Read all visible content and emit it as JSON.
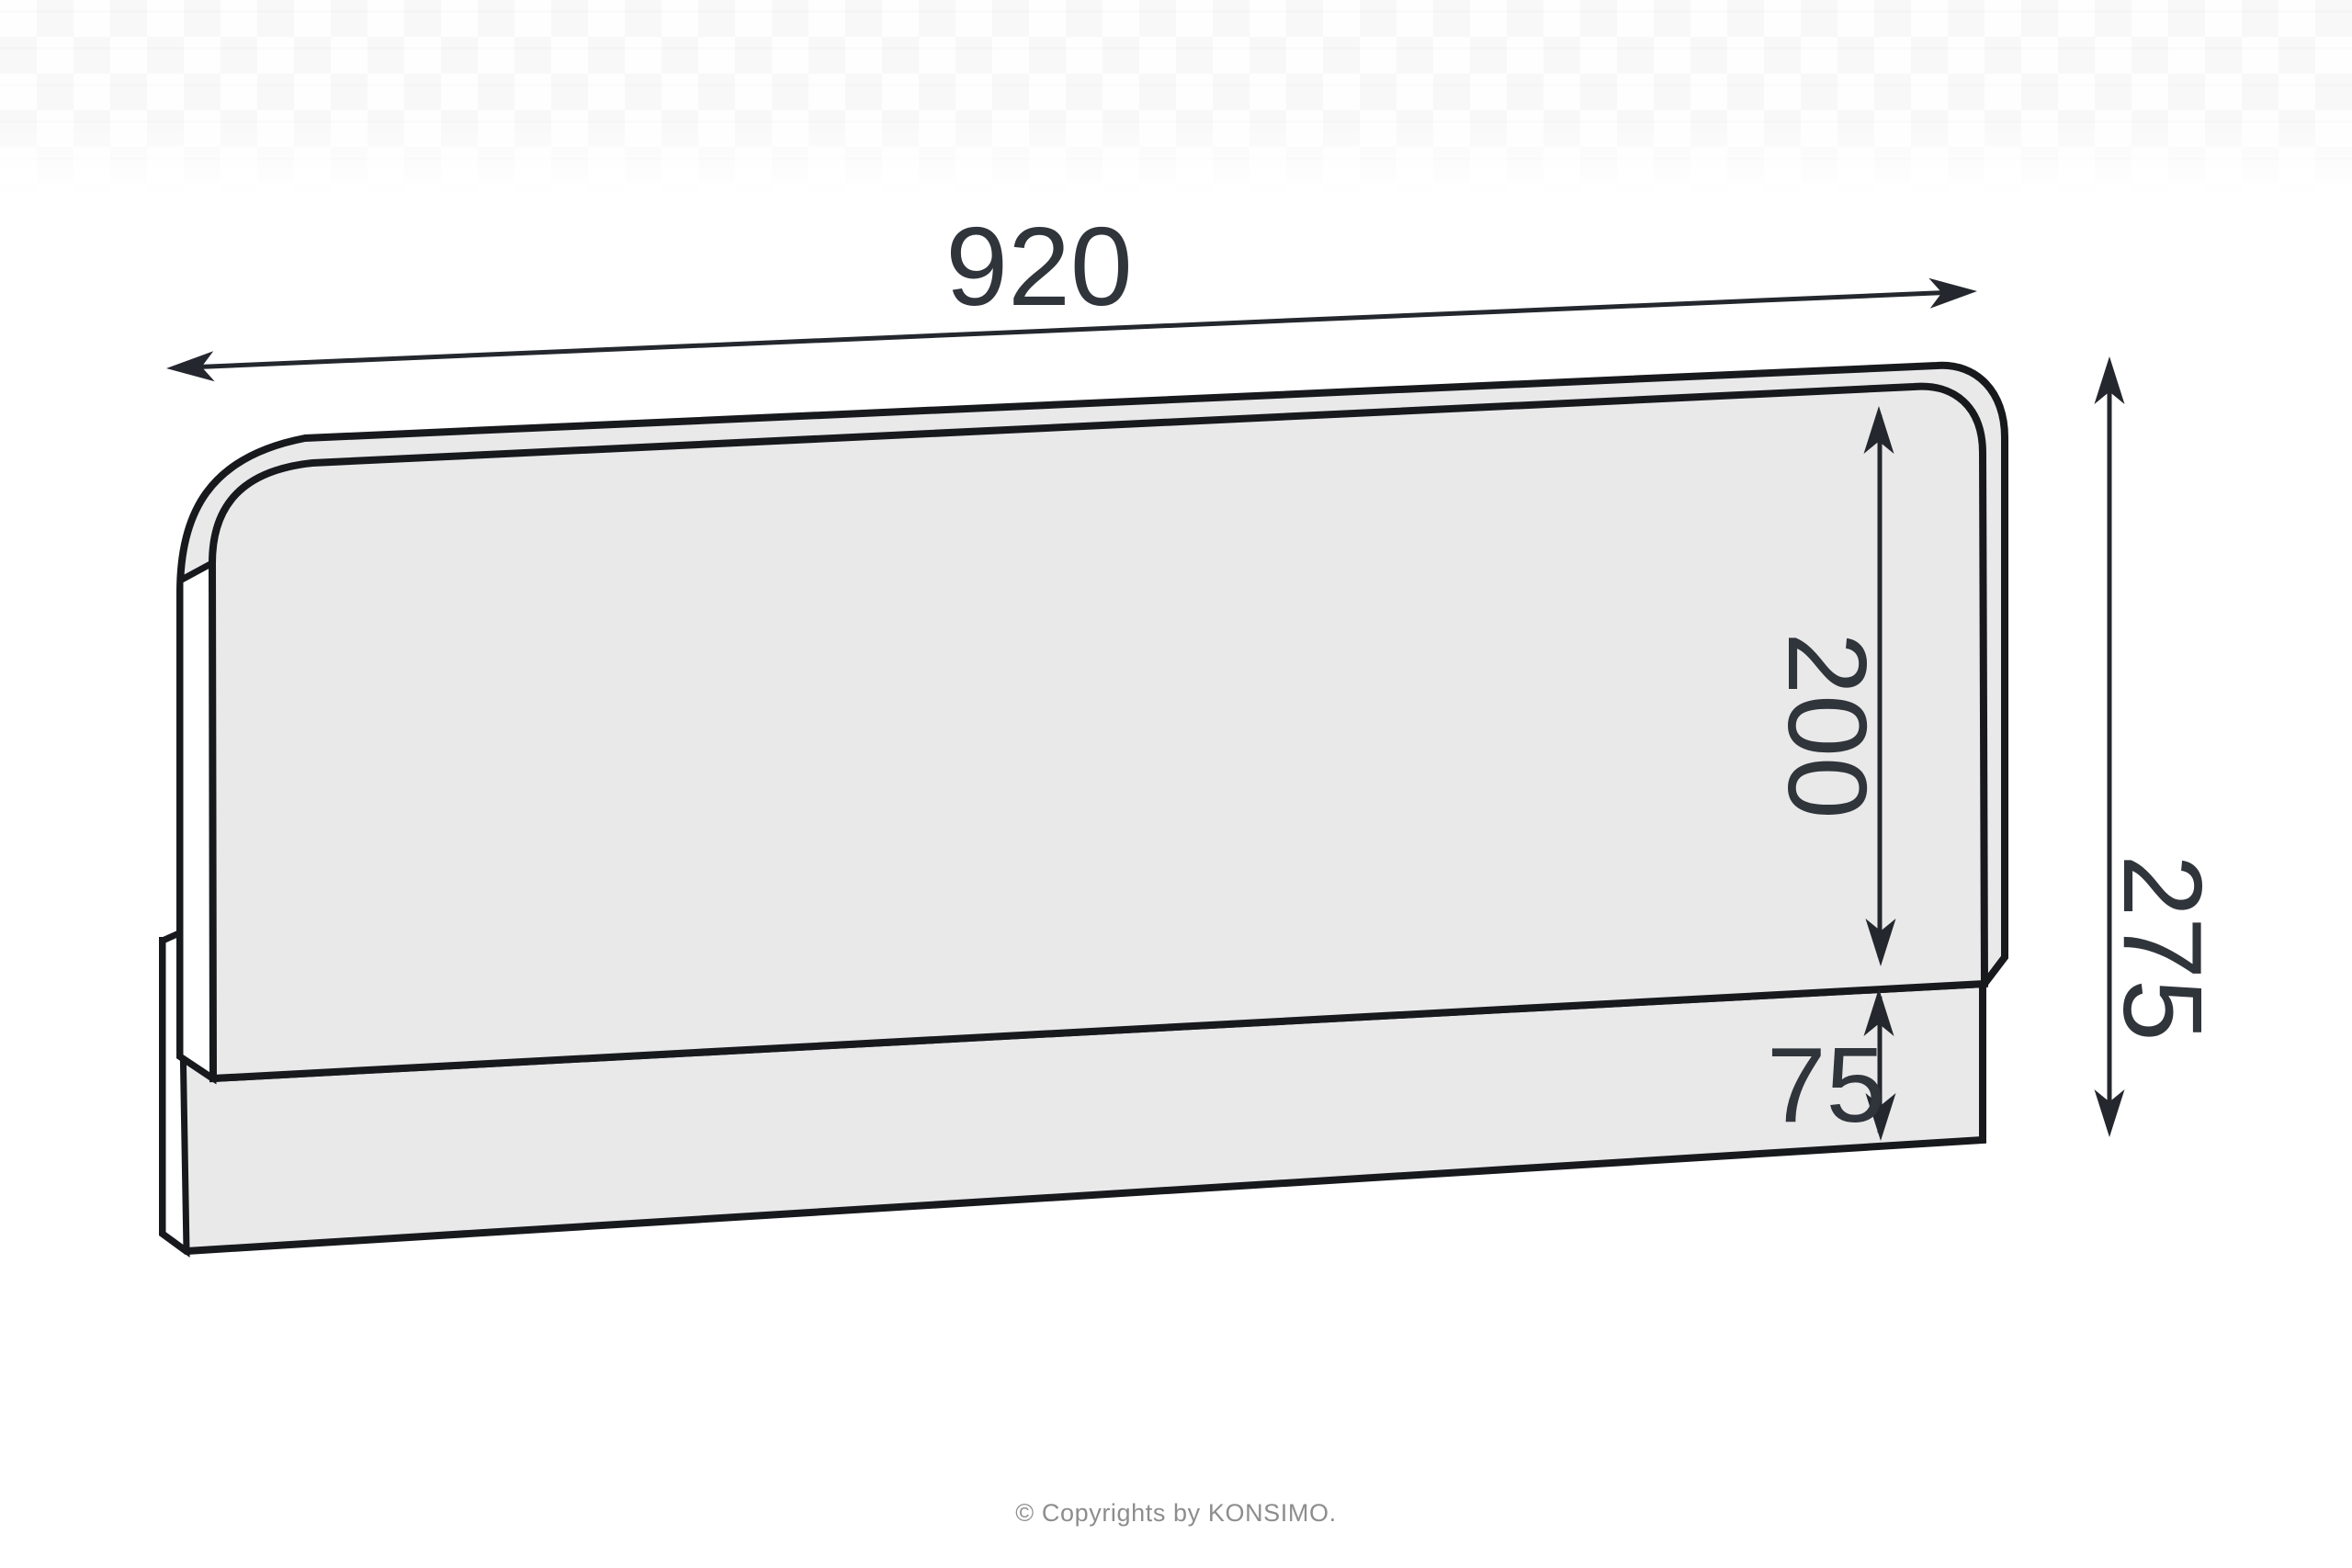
{
  "diagram": {
    "type": "furniture-technical-drawing",
    "subject": "headboard panel with base rail, perspective outline drawing",
    "panel_fill": "#e9e9ea",
    "outline_color": "#17191d",
    "dimension_color": "#24282e",
    "label_color": "#30343b",
    "dimensions": {
      "width": {
        "value": "920",
        "orientation": "horizontal",
        "location": "top"
      },
      "panel_height": {
        "value": "200",
        "orientation": "vertical",
        "location": "inside panel right"
      },
      "rail_height": {
        "value": "75",
        "orientation": "vertical",
        "location": "bottom rail right"
      },
      "total_height": {
        "value": "275",
        "orientation": "vertical",
        "location": "far right"
      }
    }
  },
  "footer": {
    "copyright": "© Copyrights by KONSIMO."
  }
}
